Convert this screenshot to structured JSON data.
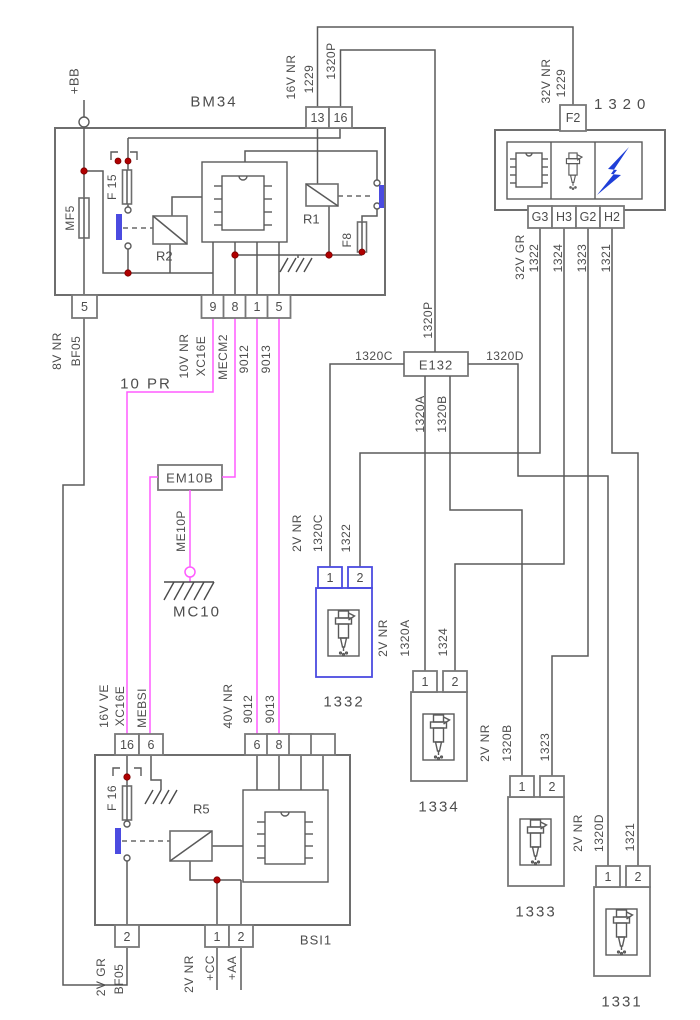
{
  "colors": {
    "wire": "#5a5a5a",
    "outline": "#6e6e6e",
    "magenta": "#ff5cff",
    "highlight_blue": "#4b4be0",
    "junction_red": "#b00000",
    "text": "#4d4d4d",
    "bolt_blue": "#1f3fd8"
  },
  "bm34": {
    "label": "BM34",
    "battery": "+BB",
    "mf5": "MF5",
    "f15": "F 15",
    "f8": "F8",
    "r1": "R1",
    "r2": "R2",
    "pin13": "13",
    "pin16": "16",
    "pin5_left": "5",
    "pin9": "9",
    "pin8": "8",
    "pin1": "1",
    "pin5": "5"
  },
  "feeds": {
    "w16v": "16V NR",
    "w1229a": "1229",
    "w1320p": "1320P",
    "w32v": "32V NR",
    "w1229b": "1229"
  },
  "ecu": {
    "label": "1320",
    "f2": "F2",
    "g3": "G3",
    "h3": "H3",
    "g2": "G2",
    "h2": "H2",
    "out_gauge": "32V GR",
    "w1322": "1322",
    "w1324": "1324",
    "w1323": "1323",
    "w1321": "1321"
  },
  "left": {
    "gauge": "8V NR",
    "name": "BF05"
  },
  "harness": "10 PR",
  "bm34_out": {
    "gauge": "10V NR",
    "xc16e": "XC16E",
    "mecm2": "MECM2",
    "w9012": "9012",
    "w9013": "9013"
  },
  "e132": {
    "label": "E132",
    "p": "1320P",
    "a": "1320A",
    "b": "1320B",
    "c": "1320C",
    "d": "1320D"
  },
  "em10b": {
    "label": "EM10B",
    "wire": "ME10P",
    "ground": "MC10"
  },
  "injectors": [
    {
      "id": "1332",
      "pin1": "1",
      "pin2": "2",
      "gauge": "2V NR",
      "feed": "1320C",
      "cmd": "1322"
    },
    {
      "id": "1334",
      "pin1": "1",
      "pin2": "2",
      "gauge": "2V NR",
      "feed": "1320A",
      "cmd": "1324"
    },
    {
      "id": "1333",
      "pin1": "1",
      "pin2": "2",
      "gauge": "2V NR",
      "feed": "1320B",
      "cmd": "1323"
    },
    {
      "id": "1331",
      "pin1": "1",
      "pin2": "2",
      "gauge": "2V NR",
      "feed": "1320D",
      "cmd": "1321"
    }
  ],
  "bsi": {
    "label": "BSI1",
    "f16": "F 16",
    "r5": "R5",
    "pin16": "16",
    "pin6_left": "6",
    "pin6": "6",
    "pin8": "8",
    "pin2_left": "2",
    "pin1": "1",
    "pin2": "2",
    "w16v_ve": "16V VE",
    "xc16e": "XC16E",
    "mebsi": "MEBSI",
    "w40v": "40V NR",
    "w9012": "9012",
    "w9013": "9013",
    "w2v_gr": "2V GR",
    "bf05": "BF05",
    "w2v_nr": "2V NR",
    "cc": "+CC",
    "aa": "+AA"
  }
}
